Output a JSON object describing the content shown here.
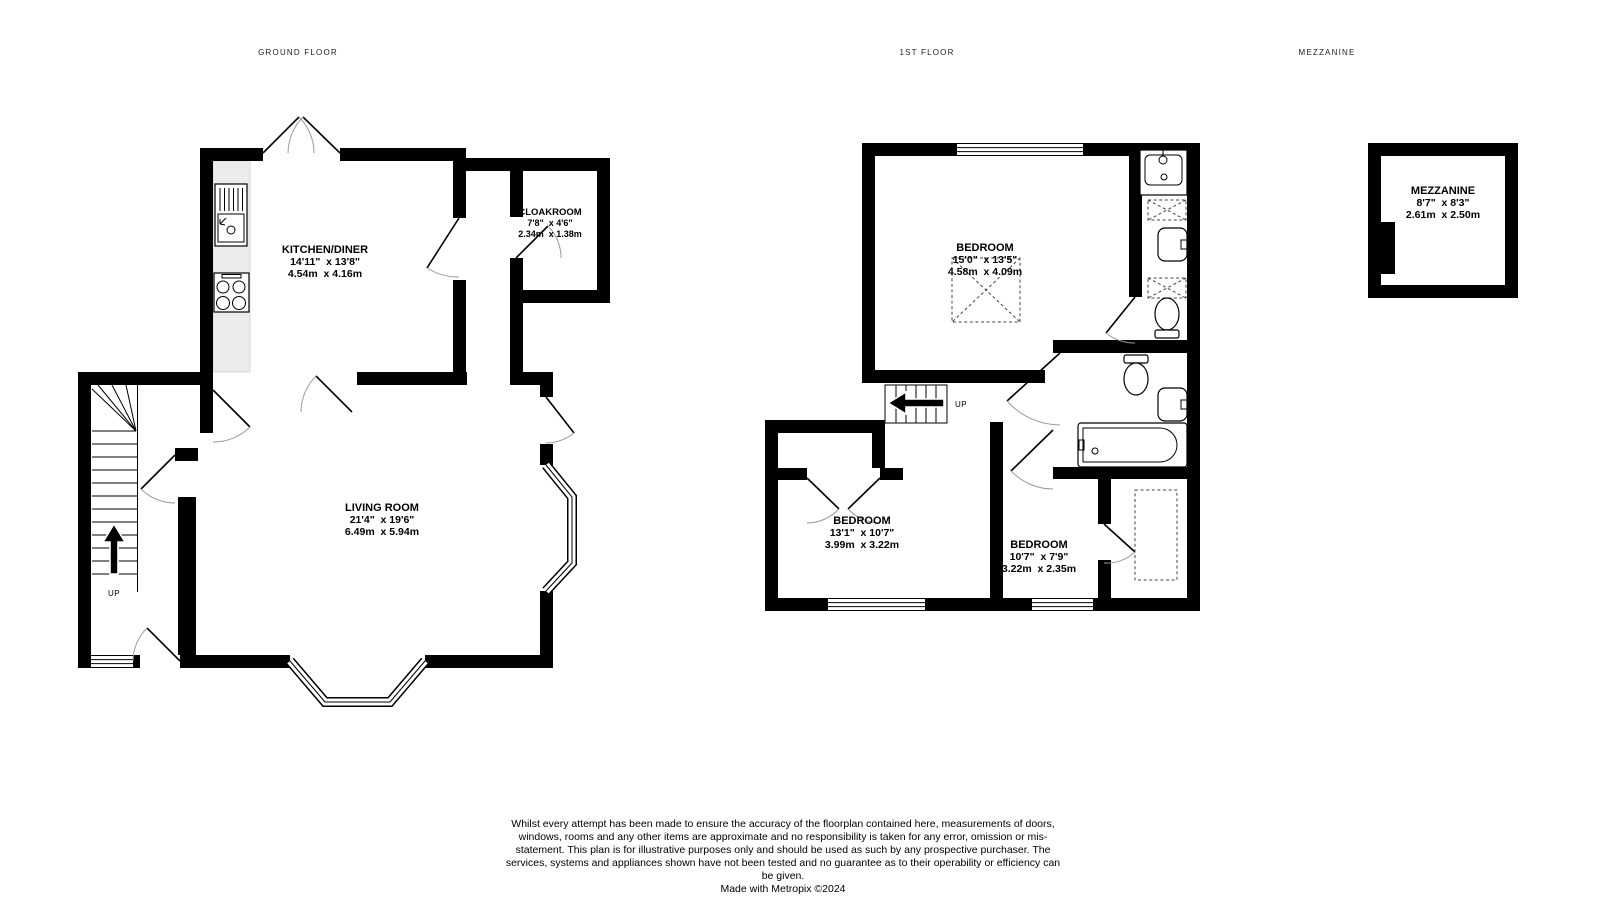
{
  "titles": {
    "ground": "GROUND FLOOR",
    "first": "1ST FLOOR",
    "mezzanine": "MEZZANINE"
  },
  "rooms": {
    "kitchen": {
      "name": "KITCHEN/DINER",
      "imperial": "14'11\"  x 13'8\"",
      "metric": "4.54m  x 4.16m"
    },
    "cloakroom": {
      "name": "CLOAKROOM",
      "imperial": "7'8\"  x 4'6\"",
      "metric": "2.34m  x 1.38m"
    },
    "living": {
      "name": "LIVING ROOM",
      "imperial": "21'4\"  x 19'6\"",
      "metric": "6.49m  x 5.94m"
    },
    "bedroom1": {
      "name": "BEDROOM",
      "imperial": "15'0\"  x 13'5\"",
      "metric": "4.58m  x 4.09m"
    },
    "bedroom2": {
      "name": "BEDROOM",
      "imperial": "13'1\"  x 10'7\"",
      "metric": "3.99m  x 3.22m"
    },
    "bedroom3": {
      "name": "BEDROOM",
      "imperial": "10'7\"  x 7'9\"",
      "metric": "3.22m  x 2.35m"
    },
    "mezzanine": {
      "name": "MEZZANINE",
      "imperial": "8'7\"  x 8'3\"",
      "metric": "2.61m  x 2.50m"
    }
  },
  "stairs": {
    "ground_up": "UP",
    "first_up": "UP"
  },
  "footer": {
    "disclaimer": "Whilst every attempt has been made to ensure the accuracy of the floorplan contained here, measurements of doors, windows, rooms and any other items are approximate and no responsibility is taken for any error, omission or mis-statement. This plan is for illustrative purposes only and should be used as such by any prospective purchaser. The services, systems and appliances shown have not been tested and no guarantee as to their operability or efficiency can be given.",
    "credit": "Made with Metropix ©2024"
  },
  "colors": {
    "wall": "#000000",
    "counter": "#ececec",
    "door_arc": "#9a9a9a"
  }
}
